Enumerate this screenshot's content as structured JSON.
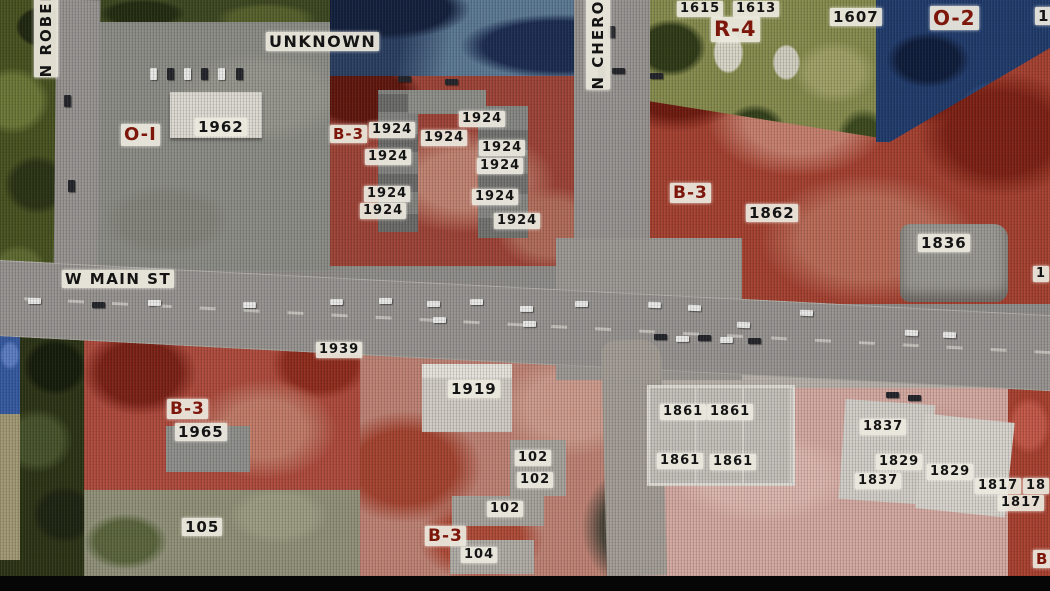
{
  "map": {
    "title": "zoning-aerial-map",
    "streets": [
      {
        "text": "N ROBER",
        "x": 34,
        "y": -12,
        "vertical": true,
        "s": 15
      },
      {
        "text": "UNKNOWN",
        "x": 266,
        "y": 32,
        "vertical": false,
        "s": 16
      },
      {
        "text": "N CHEROK",
        "x": 586,
        "y": -14,
        "vertical": true,
        "s": 15
      },
      {
        "text": "W MAIN ST",
        "x": 62,
        "y": 270,
        "vertical": false,
        "s": 15
      }
    ],
    "zone_labels": [
      {
        "text": "O-I",
        "x": 121,
        "y": 124,
        "s": 18
      },
      {
        "text": "B-3",
        "x": 330,
        "y": 125,
        "s": 15
      },
      {
        "text": "R-4",
        "x": 711,
        "y": 17,
        "s": 21
      },
      {
        "text": "O-2",
        "x": 930,
        "y": 6,
        "s": 20
      },
      {
        "text": "B-3",
        "x": 670,
        "y": 183,
        "s": 17
      },
      {
        "text": "B-3",
        "x": 167,
        "y": 399,
        "s": 17
      },
      {
        "text": "B-3",
        "x": 425,
        "y": 526,
        "s": 17
      },
      {
        "text": "B",
        "x": 1033,
        "y": 550,
        "s": 15
      }
    ],
    "parcels": [
      {
        "text": "1962",
        "x": 195,
        "y": 118,
        "s": 15
      },
      {
        "text": "1924",
        "x": 369,
        "y": 122
      },
      {
        "text": "1924",
        "x": 459,
        "y": 111
      },
      {
        "text": "1924",
        "x": 421,
        "y": 130
      },
      {
        "text": "1924",
        "x": 479,
        "y": 140
      },
      {
        "text": "1924",
        "x": 365,
        "y": 149
      },
      {
        "text": "1924",
        "x": 477,
        "y": 158
      },
      {
        "text": "1924",
        "x": 364,
        "y": 186
      },
      {
        "text": "1924",
        "x": 472,
        "y": 189
      },
      {
        "text": "1924",
        "x": 360,
        "y": 203
      },
      {
        "text": "1924",
        "x": 494,
        "y": 213
      },
      {
        "text": "1615",
        "x": 677,
        "y": 1
      },
      {
        "text": "1613",
        "x": 733,
        "y": 1
      },
      {
        "text": "1607",
        "x": 830,
        "y": 8,
        "s": 15
      },
      {
        "text": "16",
        "x": 1035,
        "y": 7,
        "s": 15
      },
      {
        "text": "1862",
        "x": 746,
        "y": 204,
        "s": 15
      },
      {
        "text": "1836",
        "x": 918,
        "y": 234,
        "s": 15
      },
      {
        "text": "1",
        "x": 1033,
        "y": 266
      },
      {
        "text": "1939",
        "x": 316,
        "y": 342
      },
      {
        "text": "1965",
        "x": 175,
        "y": 423,
        "s": 15
      },
      {
        "text": "105",
        "x": 182,
        "y": 518,
        "s": 15
      },
      {
        "text": "1919",
        "x": 448,
        "y": 380,
        "s": 15
      },
      {
        "text": "102",
        "x": 515,
        "y": 450
      },
      {
        "text": "102",
        "x": 517,
        "y": 472
      },
      {
        "text": "102",
        "x": 487,
        "y": 501
      },
      {
        "text": "104",
        "x": 461,
        "y": 547
      },
      {
        "text": "1861",
        "x": 660,
        "y": 404
      },
      {
        "text": "1861",
        "x": 707,
        "y": 404
      },
      {
        "text": "1861",
        "x": 657,
        "y": 453
      },
      {
        "text": "1861",
        "x": 710,
        "y": 454
      },
      {
        "text": "1837",
        "x": 860,
        "y": 419
      },
      {
        "text": "1829",
        "x": 876,
        "y": 454
      },
      {
        "text": "1829",
        "x": 927,
        "y": 464
      },
      {
        "text": "1837",
        "x": 855,
        "y": 473
      },
      {
        "text": "1817",
        "x": 975,
        "y": 478
      },
      {
        "text": "18",
        "x": 1023,
        "y": 478
      },
      {
        "text": "1817",
        "x": 998,
        "y": 495
      }
    ],
    "colors": {
      "b3_red": "#a4402f",
      "r4_olive": "#858a4c",
      "o2_navy": "#203b6b",
      "oi_gray": "#8b8b85",
      "residential_pink": "#d2a89f",
      "road_gray": "#96938f",
      "chip_background": "#ece9df",
      "zone_label_text": "#7d170c",
      "parcel_label_text": "#141414"
    }
  }
}
